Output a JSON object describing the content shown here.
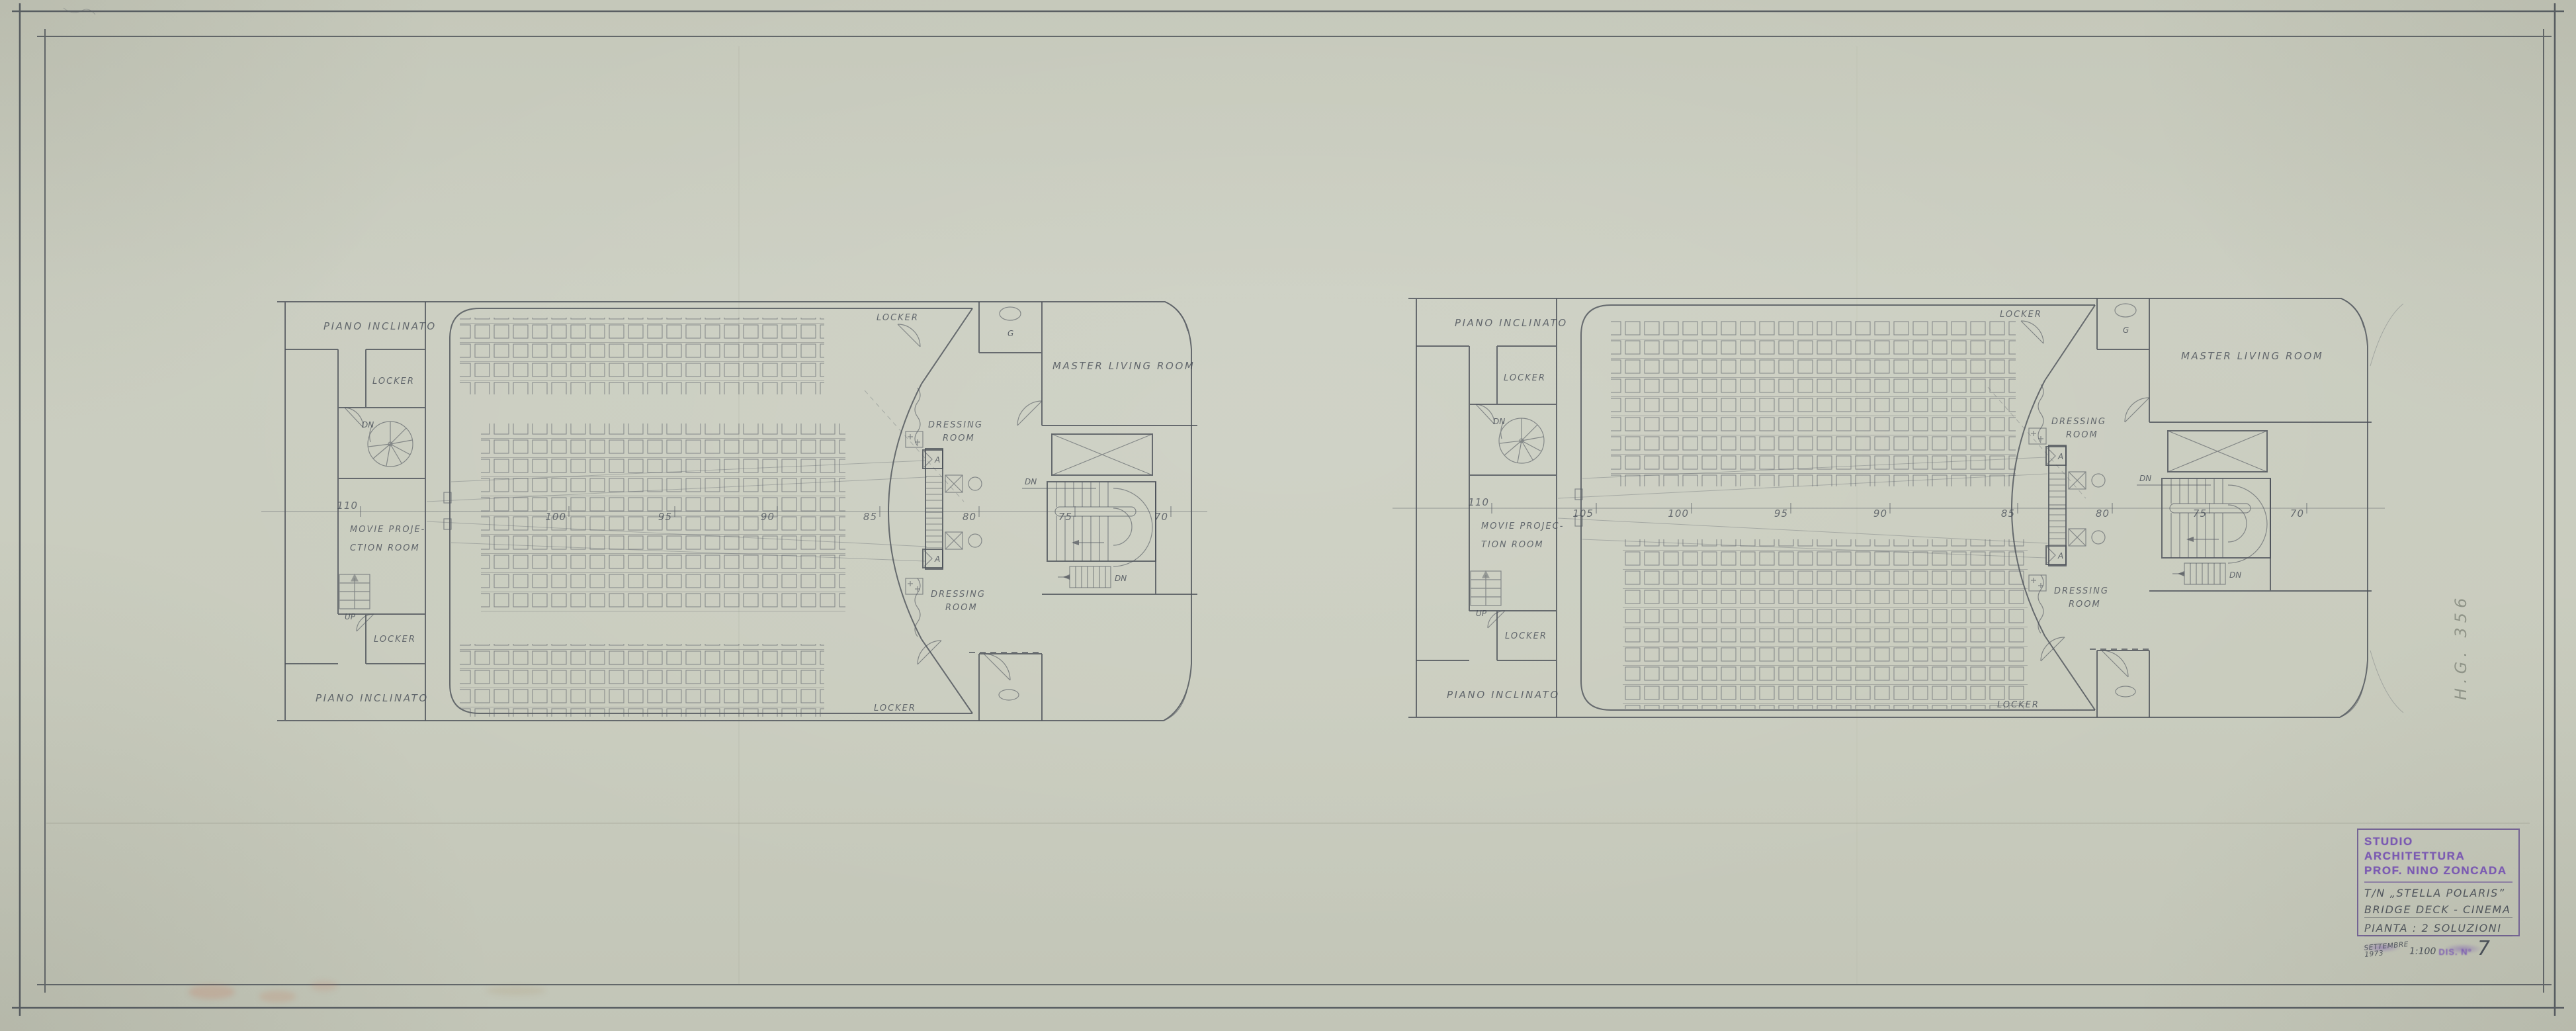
{
  "labels": {
    "piano_inclinato": "PIANO INCLINATO",
    "locker": "LOCKER",
    "lockers": "LOCKER",
    "dn": "DN",
    "up": "UP",
    "movie_left_1": "MOVIE PROJE-",
    "movie_left_2": "CTION ROOM",
    "movie_right_1": "MOVIE PROJEC-",
    "movie_right_2": "TION ROOM",
    "master_living_room": "MASTER LIVING ROOM",
    "dressing_1": "DRESSING",
    "dressing_2": "ROOM",
    "wc": "G",
    "speaker": "A"
  },
  "frames": {
    "left": [
      "110",
      "100",
      "95",
      "90",
      "85",
      "80",
      "75",
      "70"
    ],
    "right": [
      "110",
      "105",
      "100",
      "95",
      "90",
      "85",
      "80",
      "75",
      "70"
    ]
  },
  "title_block": {
    "studio_line1": "STUDIO ARCHITETTURA",
    "studio_line2": "PROF. NINO ZONCADA",
    "project": "T/N „STELLA POLARIS”",
    "subject": "BRIDGE DECK - CINEMA",
    "plan_type": "PIANTA : 2 SOLUZIONI",
    "date": "SETTEMBRE 1973",
    "scale": "1:100",
    "drawing_no_label": "DIS. N°",
    "drawing_no": "7"
  },
  "side_note": "H.G. 356",
  "colors": {
    "paper": "#c9ccbe",
    "pencil": "#4b5058",
    "stamp_violet": "#7b5ab2"
  }
}
